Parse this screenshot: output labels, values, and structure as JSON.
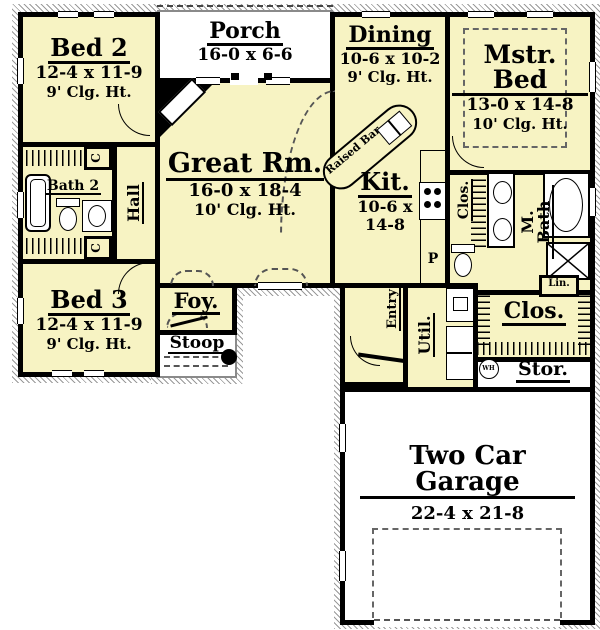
{
  "plan": {
    "colors": {
      "room_fill": "#F7F3C3",
      "wall": "#000000",
      "hatch_edge": "#9A9A9A",
      "exterior": "#FFFFFF"
    },
    "rooms": {
      "porch": {
        "name": "Porch",
        "dims": "16-0 x 6-6"
      },
      "bed2": {
        "name": "Bed 2",
        "dims": "12-4 x 11-9",
        "ceiling": "9' Clg. Ht."
      },
      "bath2": {
        "name": "Bath 2"
      },
      "hall": {
        "name": "Hall"
      },
      "closet_c1": {
        "name": "C"
      },
      "closet_c2": {
        "name": "C"
      },
      "bed3": {
        "name": "Bed 3",
        "dims": "12-4 x 11-9",
        "ceiling": "9' Clg. Ht."
      },
      "great": {
        "name": "Great Rm.",
        "dims": "16-0 x 18-4",
        "ceiling": "10' Clg. Ht."
      },
      "dining": {
        "name": "Dining",
        "dims": "10-6 x 10-2",
        "ceiling": "9' Clg. Ht."
      },
      "mstr": {
        "name": "Mstr. Bed",
        "dims": "13-0 x 14-8",
        "ceiling": "10' Clg. Ht."
      },
      "kit": {
        "name": "Kit.",
        "dims_line1": "10-6 x",
        "dims_line2": "14-8"
      },
      "raised_bar": {
        "name": "Raised Bar"
      },
      "pantry": {
        "name": "P"
      },
      "mstr_clos": {
        "name": "Clos."
      },
      "mbath": {
        "name": "M. Bath"
      },
      "lin": {
        "name": "Lin."
      },
      "foyer": {
        "name": "Foy."
      },
      "stoop": {
        "name": "Stoop"
      },
      "entry": {
        "name": "Entry"
      },
      "util": {
        "name": "Util."
      },
      "walkin_clos": {
        "name": "Clos."
      },
      "stor": {
        "name": "Stor."
      },
      "water_heater": {
        "name": "WH"
      },
      "garage": {
        "name": "Two Car Garage",
        "dims": "22-4 x 21-8"
      }
    }
  }
}
